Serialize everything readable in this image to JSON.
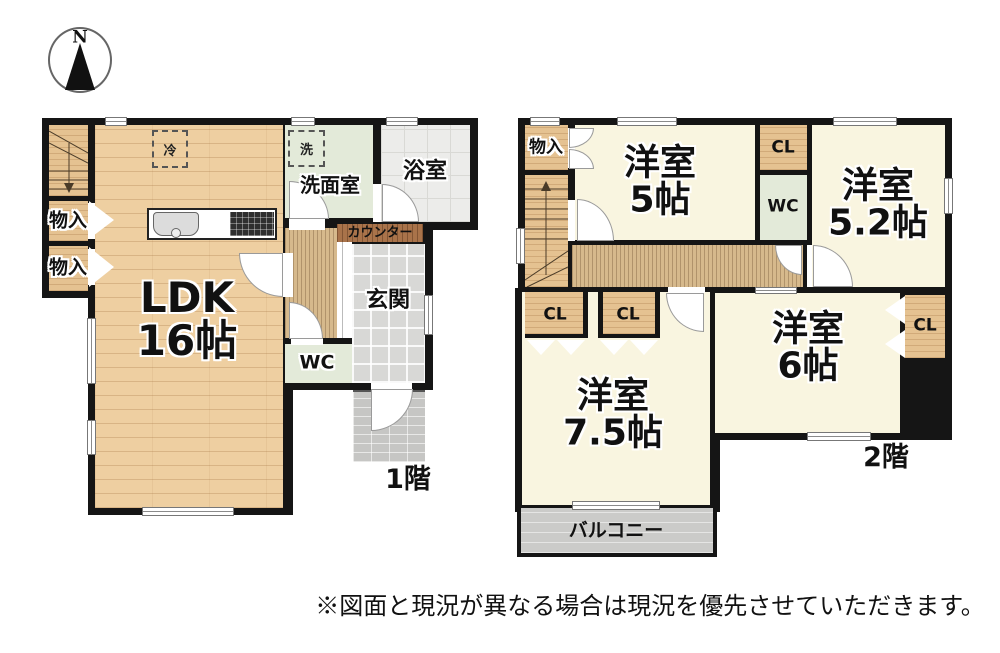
{
  "compass": {
    "label": "N"
  },
  "floor1": {
    "name_label": "1階",
    "rooms": {
      "ldk": {
        "line1": "LDK",
        "line2": "16帖"
      },
      "monoire1": "物入",
      "monoire2": "物入",
      "senmenshitsu": "洗面室",
      "yokushitsu": "浴室",
      "genkan": "玄関",
      "wc": "WC",
      "counter": "カウンター",
      "refrigerator": "冷",
      "washer": "洗"
    }
  },
  "floor2": {
    "name_label": "2階",
    "rooms": {
      "monoire": "物入",
      "yoshitsu5": {
        "line1": "洋室",
        "line2": "5帖"
      },
      "yoshitsu52": {
        "line1": "洋室",
        "line2": "5.2帖"
      },
      "yoshitsu75": {
        "line1": "洋室",
        "line2": "7.5帖"
      },
      "yoshitsu6": {
        "line1": "洋室",
        "line2": "6帖"
      },
      "cl_top": "CL",
      "wc": "WC",
      "cl1": "CL",
      "cl2": "CL",
      "cl_right": "CL",
      "balcony": "バルコニー"
    }
  },
  "disclaimer": "※図面と現況が異なる場合は現況を優先させていただきます。",
  "colors": {
    "wall": "#151515",
    "wood_floor": "#eecfa1",
    "closet_wood": "#e5c291",
    "hallway_wood": "#d6b98c",
    "counter_wood": "#a9734a",
    "room_cream": "#f9f5e0",
    "wet_area_green": "#e3ead9",
    "bath_gray": "#ececea",
    "genkan_tile": "#d8d8d6",
    "porch_brick": "#c6c6c4",
    "balcony_gray": "#cbcbc9"
  }
}
